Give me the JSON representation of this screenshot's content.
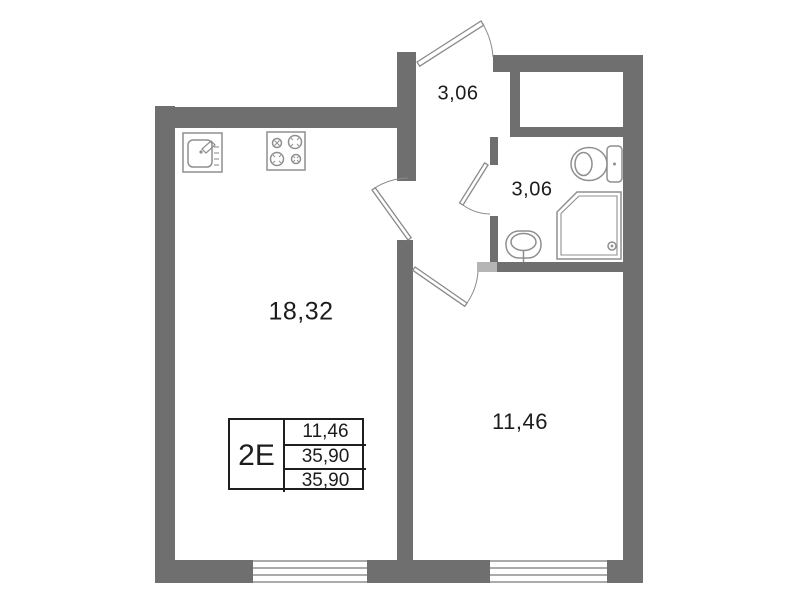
{
  "plan": {
    "title": "apartment floor plan",
    "info_box": {
      "type": "2Е",
      "living_area": "11,46",
      "total_area": "35,90",
      "overall_area": "35,90"
    },
    "rooms": {
      "kitchen_living": {
        "area": "18,32"
      },
      "bedroom": {
        "area": "11,46"
      },
      "hall": {
        "area": "3,06"
      },
      "bathroom": {
        "area": "3,06"
      }
    },
    "fixtures": [
      "kitchen-sink-icon",
      "stove-icon",
      "toilet-icon",
      "shower-icon",
      "washbasin-icon"
    ],
    "doors": [
      "entrance-door",
      "living-room-door",
      "bathroom-door",
      "bedroom-door"
    ],
    "window_count": 2,
    "colors": {
      "wall": "#6f6f6f",
      "wall_light": "#b5b5b5",
      "fixture_line": "#8f8f8f",
      "window_line": "#8f8f8f",
      "door_line": "#8a8a8a",
      "arc_line": "#a9a9a9",
      "text": "#1c1c1c",
      "table_border": "#1f1f1f",
      "background": "#ffffff"
    }
  }
}
